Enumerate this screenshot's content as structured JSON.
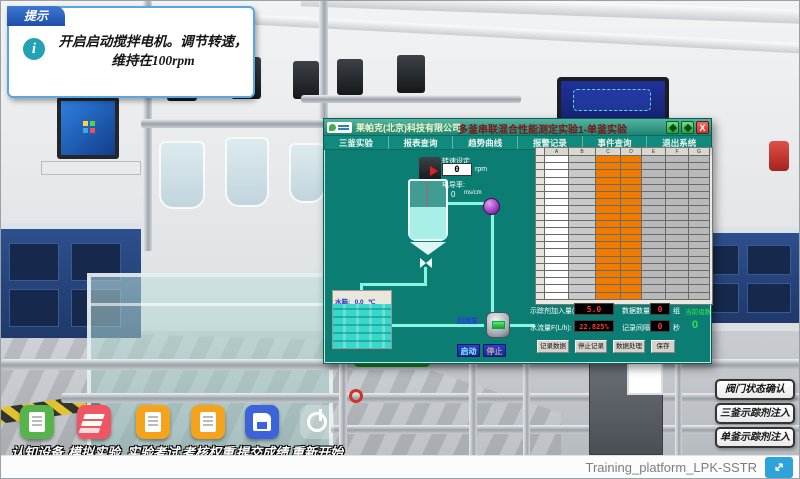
{
  "hint": {
    "tab": "提示",
    "line1": "开启启动搅拌电机。调节转速，",
    "line2": "维持在100rpm"
  },
  "scada": {
    "company": "莱帕克(北京)科技有限公司",
    "title": "多釜串联混合性能测定实验1-单釜实验",
    "window_buttons": {
      "restore": "restore-icon",
      "maximize": "maximize-icon",
      "close": "X"
    },
    "menu": [
      "三釜实验",
      "报表查询",
      "趋势曲线",
      "报警记录",
      "事件查询",
      "退出系统"
    ],
    "diagram": {
      "speed_label": "转速设定",
      "speed_value": "0",
      "speed_unit": "rpm",
      "cond_label": "电导率:",
      "cond_value": "0",
      "cond_unit": "ms/cm",
      "tank_label": "水箱:",
      "tank_temp": "0.0",
      "tank_unit": "℃",
      "pump_label": "回流泵",
      "start": "启动",
      "stop": "停止"
    },
    "table": {
      "col_headers": [
        "A",
        "B",
        "C",
        "D",
        "E",
        "F",
        "G"
      ],
      "col_widths": [
        24,
        27,
        25,
        21,
        24,
        23,
        21
      ],
      "col_fills": [
        "#ffffff",
        "#c9c9c9",
        "#ef7c00",
        "#ef7c00",
        "#b9b9b9",
        "#b9b9b9",
        "#b9b9b9"
      ],
      "row_count": 20
    },
    "controls": {
      "tracer_label": "示踪剂加入量(mol):",
      "tracer_value": "5.0",
      "flow_label": "水流量F(L/h):",
      "flow_value": "22.825%",
      "count_label": "数据数量:",
      "count_value": "0",
      "count_unit": "组",
      "interval_label": "记录间隔:",
      "interval_value": "0",
      "interval_unit": "秒",
      "group_label": "当前组数",
      "group_value": "0",
      "btn_record": "记录数据",
      "btn_stoprec": "停止记录",
      "btn_process": "数据处理",
      "btn_save": "保存"
    },
    "accent_colors": {
      "panel_teal": "#0c7d72",
      "table_orange": "#ef7c00",
      "value_red": "#ff3b30",
      "group_green": "#35e24a"
    }
  },
  "toolbar": {
    "items": [
      {
        "label": "认知设备",
        "icon": "device-document-icon",
        "color": "#57b44c"
      },
      {
        "label": "模拟实验",
        "icon": "layers-icon",
        "color": "#ef5564"
      },
      {
        "label": "实验考试",
        "icon": "exam-document-icon",
        "color": "#f5a31c"
      },
      {
        "label": "考核权重",
        "icon": "weight-document-icon",
        "color": "#f5a31c"
      },
      {
        "label": "提交成绩",
        "icon": "save-disk-icon",
        "color": "#3d63d8"
      },
      {
        "label": "重新开始",
        "icon": "power-icon",
        "color": "rgba(255,255,255,0.25)"
      }
    ]
  },
  "side_buttons": [
    {
      "label": "阀门状态确认"
    },
    {
      "label": "三釜示踪剂注入"
    },
    {
      "label": "单釜示踪剂注入"
    }
  ],
  "footer": {
    "platform": "Training_platform_LPK-SSTR",
    "fullscreen_icon": "expand-icon"
  }
}
